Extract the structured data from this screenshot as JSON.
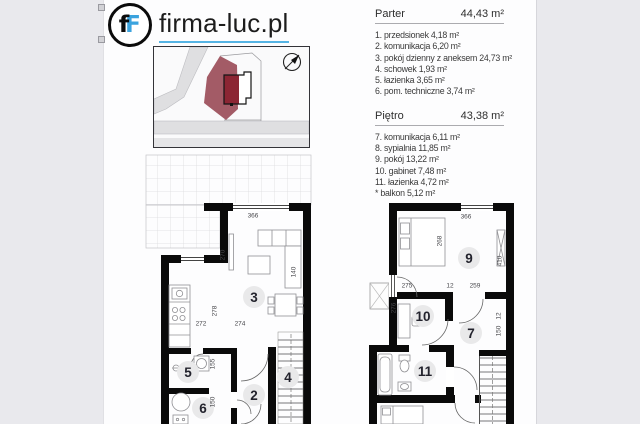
{
  "colors": {
    "background": "#E9E9ED",
    "page": "#FDFDFE",
    "wall": "#0A0A0A",
    "logo_blue": "#3BA3DE",
    "underline_blue": "#55B4E4",
    "plot_rose": "#A35B66",
    "building_red": "#8C2533",
    "road_gray": "#DFDFE1",
    "room_circle": "#E9E9EA"
  },
  "logo": {
    "icon_letter_black": "f",
    "icon_letter_blue": "F",
    "text": "firma-luc.pl"
  },
  "legend": {
    "sections": [
      {
        "title": "Parter",
        "area": "44,43 m²",
        "items": [
          "1. przedsionek 4,18 m²",
          "2. komunikacja 6,20 m²",
          "3. pokój dzienny z aneksem 24,73 m²",
          "4. schowek 1,93 m²",
          "5. łazienka 3,65 m²",
          "6. pom. techniczne 3,74 m²"
        ]
      },
      {
        "title": "Piętro",
        "area": "43,38 m²",
        "items": [
          "7. komunikacja 6,11 m²",
          "8. sypialnia 11,85 m²",
          "9. pokój 13,22 m²",
          "10. gabinet 7,48 m²",
          "11. łazienka 4,72 m²",
          "* balkon 5,12 m²"
        ]
      }
    ]
  },
  "plans": {
    "parter": {
      "rooms": [
        {
          "n": "3",
          "x": 110,
          "y": 145
        },
        {
          "n": "5",
          "x": 44,
          "y": 220
        },
        {
          "n": "6",
          "x": 59,
          "y": 256
        },
        {
          "n": "2",
          "x": 110,
          "y": 243
        },
        {
          "n": "4",
          "x": 144,
          "y": 225
        }
      ],
      "dims": [
        {
          "t": "366",
          "x": 109,
          "y": 64,
          "v": false
        },
        {
          "t": "270",
          "x": 79,
          "y": 103,
          "v": true
        },
        {
          "t": "272",
          "x": 57,
          "y": 172,
          "v": false
        },
        {
          "t": "274",
          "x": 96,
          "y": 172,
          "v": false
        },
        {
          "t": "278",
          "x": 71,
          "y": 159,
          "v": true
        },
        {
          "t": "140",
          "x": 150,
          "y": 120,
          "v": true
        },
        {
          "t": "155",
          "x": 69,
          "y": 212,
          "v": true
        },
        {
          "t": "150",
          "x": 69,
          "y": 250,
          "v": true
        }
      ]
    },
    "pietro": {
      "rooms": [
        {
          "n": "9",
          "x": 100,
          "y": 58
        },
        {
          "n": "10",
          "x": 54,
          "y": 116
        },
        {
          "n": "7",
          "x": 102,
          "y": 133
        },
        {
          "n": "11",
          "x": 56,
          "y": 171
        }
      ],
      "dims": [
        {
          "t": "366",
          "x": 97,
          "y": 17,
          "v": false
        },
        {
          "t": "268",
          "x": 71,
          "y": 41,
          "v": true
        },
        {
          "t": "410",
          "x": 131,
          "y": 61,
          "v": true
        },
        {
          "t": "275",
          "x": 38,
          "y": 86,
          "v": false
        },
        {
          "t": "12",
          "x": 81,
          "y": 86,
          "v": false
        },
        {
          "t": "259",
          "x": 106,
          "y": 86,
          "v": false
        },
        {
          "t": "276",
          "x": 25,
          "y": 108,
          "v": true
        },
        {
          "t": "12",
          "x": 130,
          "y": 116,
          "v": true
        },
        {
          "t": "150",
          "x": 130,
          "y": 131,
          "v": true
        }
      ]
    }
  }
}
